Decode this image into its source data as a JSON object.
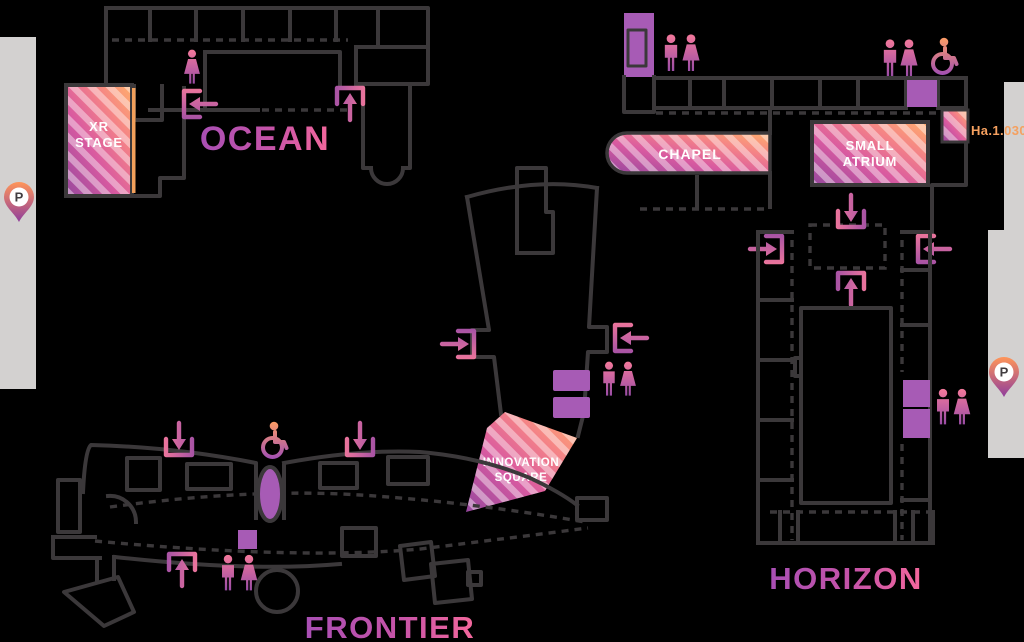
{
  "map": {
    "buildings": {
      "ocean": "OCEAN",
      "frontier": "FRONTIER",
      "horizon": "HORIZON"
    },
    "areas": {
      "xr_stage": {
        "line1": "XR",
        "line2": "STAGE"
      },
      "chapel": "CHAPEL",
      "small_atrium": {
        "line1": "SMALL",
        "line2": "ATRIUM"
      },
      "innovation_square": {
        "line1": "INNOVATION",
        "line2": "SQUARE"
      }
    },
    "room_number": "Ha.1.030",
    "parking_label": "P",
    "icons": [
      "parking-pin",
      "restroom-men",
      "restroom-women",
      "wheelchair-access",
      "elevator-block",
      "entrance-arrow-in",
      "entrance-arrow-up",
      "entrance-arrow-down"
    ],
    "colors": {
      "background": "#000000",
      "wall_outline": "#3b383a",
      "road": "#d3d1d0",
      "purple_fill": "#a75bb5",
      "stripe_gradient": [
        "#96489e",
        "#d95aa0",
        "#ffae6c"
      ],
      "label_gradient": [
        "#a94fb4",
        "#f4689c"
      ],
      "room_number_orange": "#f5a05f"
    }
  }
}
